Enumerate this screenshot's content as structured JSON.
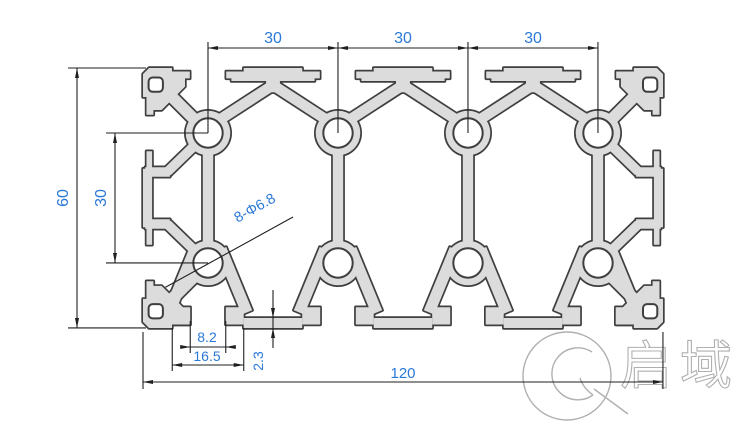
{
  "drawing": {
    "canvas": {
      "width": 756,
      "height": 428,
      "background": "#ffffff"
    },
    "units": "mm",
    "scale_px_per_mm": 4.333,
    "origin_px": {
      "x": 143,
      "y": 68
    },
    "profile": {
      "description": "aluminium extrusion cross-section 60x120 with 8 bolt holes",
      "width_mm": 120,
      "height_mm": 60,
      "slot_cols_mm": [
        15,
        45,
        75,
        105
      ],
      "hole_rows_mm": [
        15,
        45
      ],
      "hole_diameter_mm": 6.8,
      "boss_radius_mm": 5.15,
      "slot_opening_mm": 8.2,
      "slot_inner_mm": 16.5,
      "bottom_wall_mm": 2.3,
      "fill_color": "#dcdcdc",
      "outline_color": "#3f3f3f"
    },
    "dim_line_color": "#1f1f1f",
    "dim_text_color": "#2b79d8",
    "dimensions": [
      {
        "id": "pitch-1",
        "label": "30",
        "text_px": [
          273,
          43
        ],
        "rotate": 0
      },
      {
        "id": "pitch-2",
        "label": "30",
        "text_px": [
          403,
          43
        ],
        "rotate": 0
      },
      {
        "id": "pitch-3",
        "label": "30",
        "text_px": [
          533,
          43
        ],
        "rotate": 0
      },
      {
        "id": "height",
        "label": "60",
        "text_px": [
          68,
          198
        ],
        "rotate": -90
      },
      {
        "id": "row-pitch",
        "label": "30",
        "text_px": [
          106,
          198
        ],
        "rotate": -90
      },
      {
        "id": "holes",
        "label": "8-Φ6.8",
        "text_px": [
          257,
          212
        ],
        "rotate": -29
      },
      {
        "id": "slot-opening",
        "label": "8.2",
        "text_px": [
          207,
          342
        ],
        "rotate": 0
      },
      {
        "id": "slot-inner",
        "label": "16.5",
        "text_px": [
          207,
          361
        ],
        "rotate": 0
      },
      {
        "id": "wall",
        "label": "2.3",
        "text_px": [
          263,
          361
        ],
        "rotate": -90
      },
      {
        "id": "width",
        "label": "120",
        "text_px": [
          403,
          378
        ],
        "rotate": 0
      }
    ]
  },
  "watermark": {
    "logo_text": "启域",
    "color": "#b0b0b0",
    "circle_px": {
      "cx": 567,
      "cy": 376,
      "r": 44
    }
  }
}
